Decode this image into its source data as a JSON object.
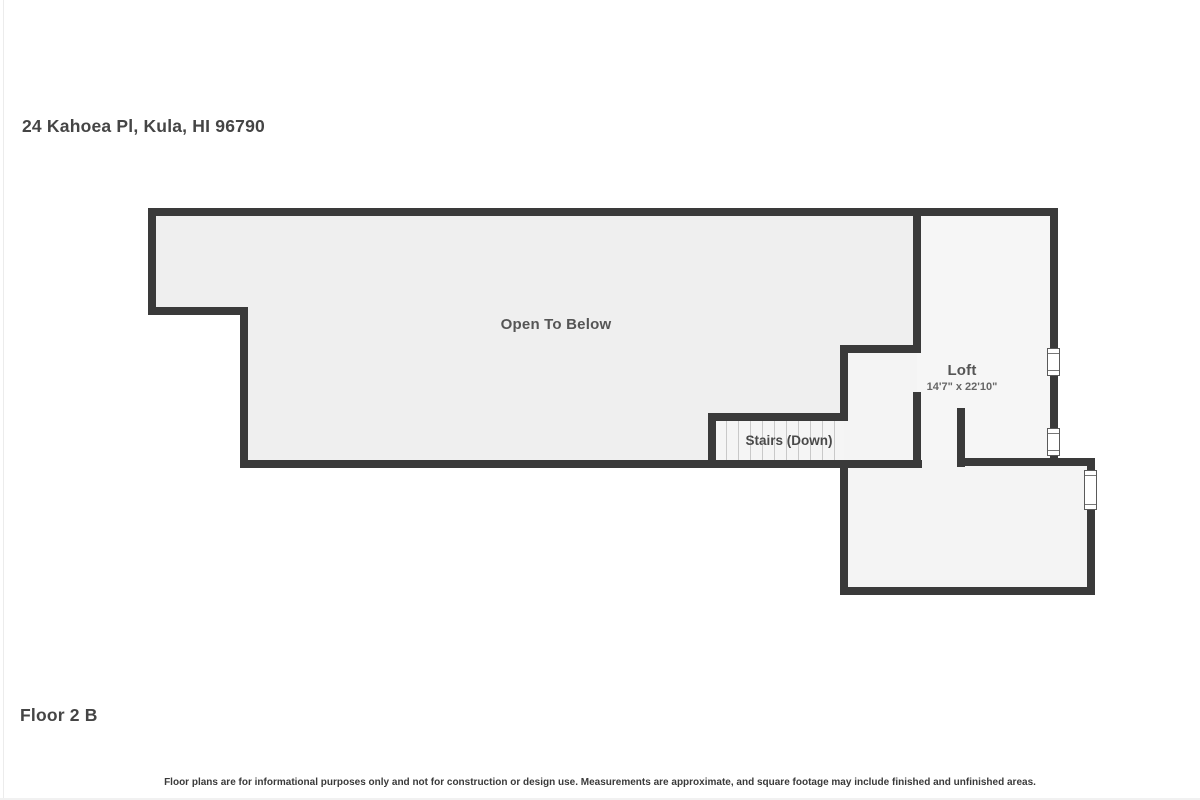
{
  "header": {
    "address": "24 Kahoea Pl, Kula, HI 96790"
  },
  "plan": {
    "labels": {
      "open_to_below": "Open To Below",
      "loft": "Loft",
      "loft_dimensions": "14'7\" x 22'10\"",
      "stairs": "Stairs (Down)"
    },
    "colors": {
      "wall": "#3a3a3a",
      "floor_main": "#efefef",
      "floor_light": "#f5f5f5",
      "floor_lighter": "#f6f6f6",
      "window_fill": "#ffffff",
      "background": "#ffffff"
    }
  },
  "footer": {
    "floor_label": "Floor 2 B",
    "disclaimer": "Floor plans are for informational purposes only and not for construction or design use. Measurements are approximate, and square footage may include finished and unfinished areas."
  }
}
